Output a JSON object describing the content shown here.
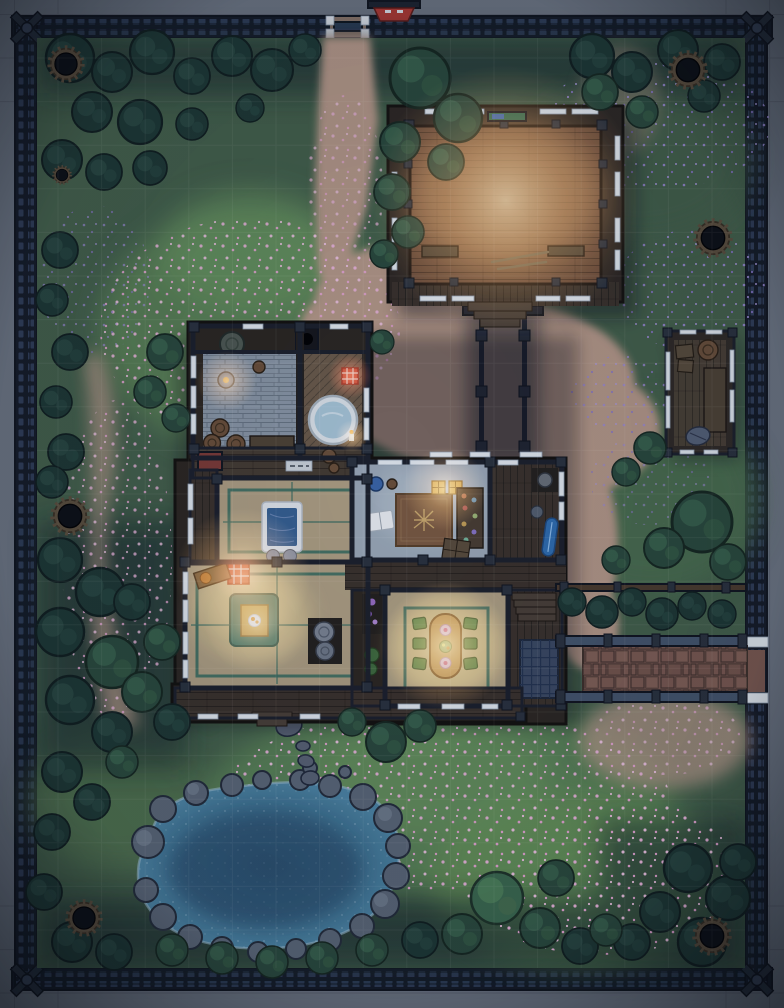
{
  "map": {
    "kind": "top-down battle map",
    "scene": "walled japanese estate at night",
    "grid_visible": true,
    "grid_cell_px": 43.6
  },
  "colors": {
    "margin_stone": "#6e7683",
    "wall": "#151b26",
    "wall_stud": "#33425c",
    "grass": "#44614a",
    "grass_bright": "#639257",
    "tree_dark": "#1e3833",
    "tree_green": "#2a4a3c",
    "petal_pink": "#eeb7dd",
    "flower_purple": "#9d8bd6",
    "path_sand": "#b79a88",
    "pond_deep": "#2b506e",
    "rock_gray": "#5c6878",
    "wood_deck": "#3a322a",
    "dojo_floor": "#6e4c38",
    "shoji_white": "#e6ecf2",
    "tatami": "#b0a183",
    "tatami_line": "#3c6e5f",
    "tile_floor": "#8b98a6",
    "bath_wood": "#6b5b49",
    "tub_water": "#a9c8da",
    "lamp_red": "#c23b2c",
    "study_floor": "#9dabb9",
    "rug_brown": "#7b5a40",
    "table_wood": "#c89a5c",
    "cushion_green": "#5b8c50",
    "paving_red": "#7c5a50",
    "fence_blue": "#46566c",
    "gate_red": "#b03a33",
    "accent_blue": "#2f6fb2",
    "glow_warm": "#ffc878"
  },
  "features": {
    "perimeter": {
      "gates": [
        "north-gate",
        "east-gate"
      ],
      "corner_posts": 4,
      "shrine_gate_roof": "red"
    },
    "wells_or_stumps": 7,
    "buildings": [
      {
        "id": "training-hall",
        "floor": "wood-planks",
        "contents": [
          "benches",
          "training-staffs",
          "weapon-rack",
          "south-steps"
        ]
      },
      {
        "id": "main-house",
        "rooms": [
          "washroom",
          "bathroom-with-tub",
          "bedroom-with-futon",
          "sitting-room-with-lamp",
          "study",
          "dining-room"
        ],
        "contents": [
          "barrels",
          "round-tub",
          "red-paper-lamps",
          "futon",
          "low-table",
          "dining-table-with-food",
          "cushions",
          "desk",
          "open-book",
          "crate",
          "blue-board",
          "stairs"
        ]
      },
      {
        "id": "storage-shed",
        "contents": [
          "crates",
          "barrels",
          "bench"
        ]
      },
      {
        "id": "covered-walkway",
        "posts": 6
      }
    ],
    "landscape": [
      "pond-with-boulders",
      "stepping-stones",
      "sand-paths",
      "stone-paved-walkway",
      "low-fences",
      "tree-masses",
      "bushes",
      "petal-covered-grass",
      "purple-flower-patches"
    ]
  }
}
